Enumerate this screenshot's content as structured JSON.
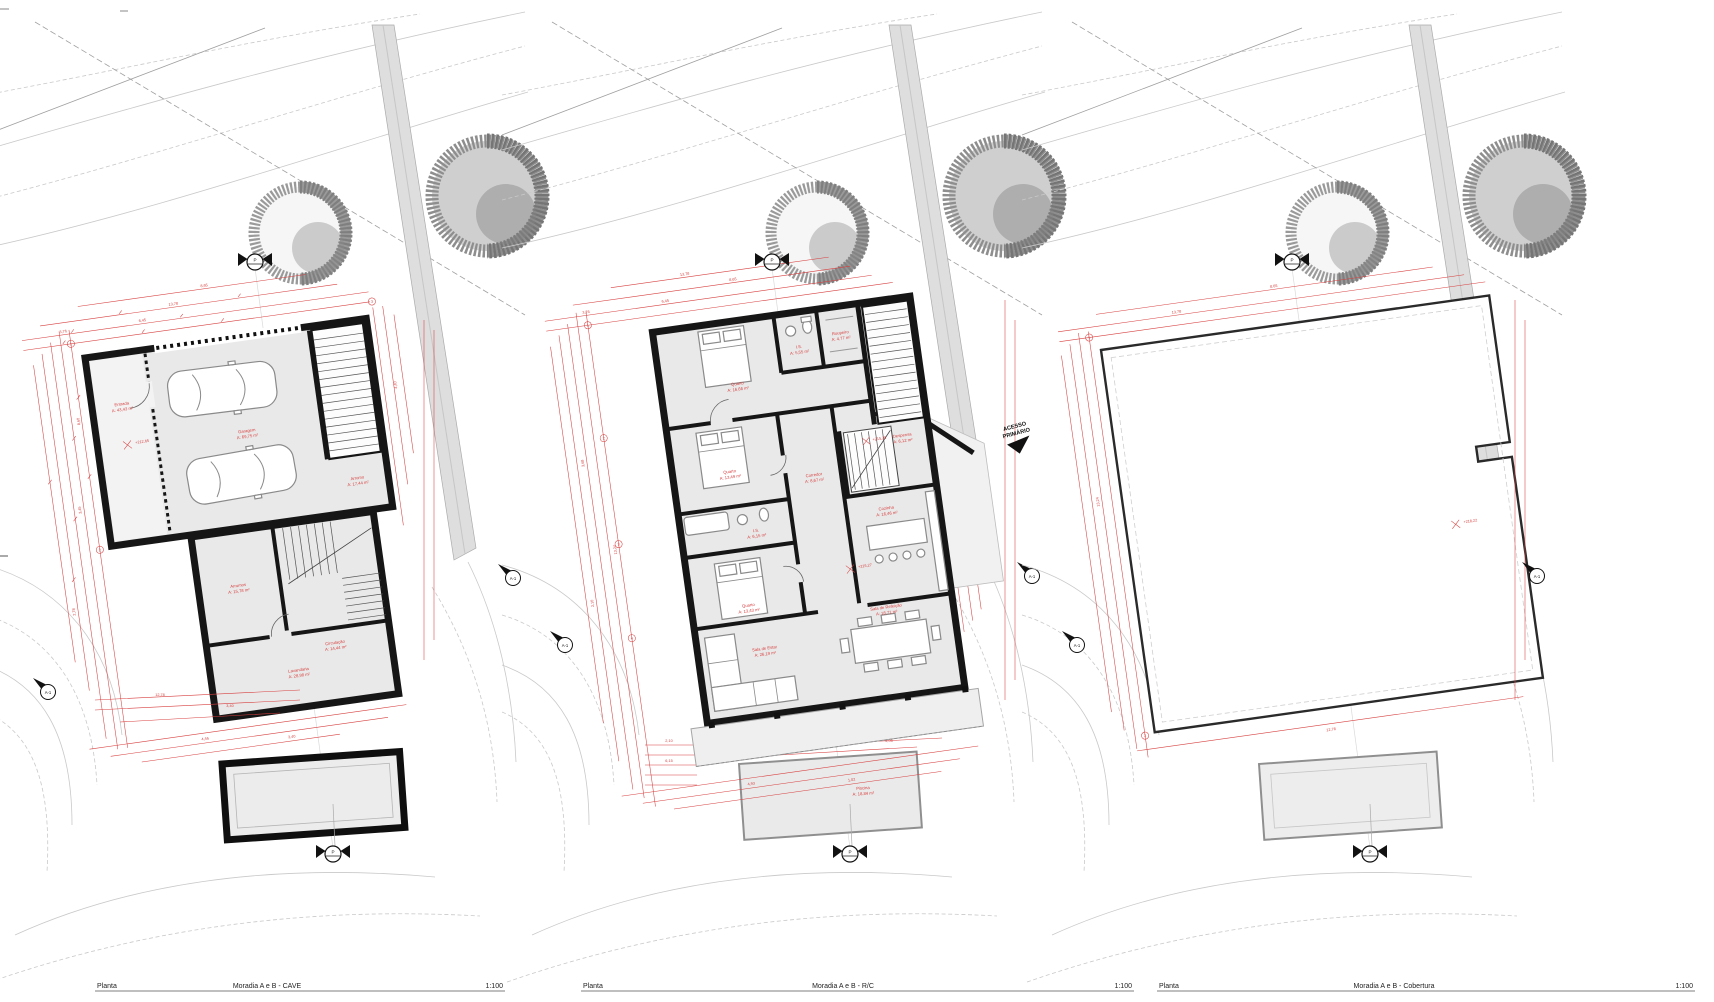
{
  "sheet": {
    "type": "Planta",
    "scale": "1:100"
  },
  "colors": {
    "dimension_red": "#d84040",
    "wall_black": "#161616",
    "floor_gray": "#e9e9e9"
  },
  "markers": {
    "section": "A-1",
    "cut": "P",
    "access_line1": "ACESSO",
    "access_line2": "PRIMÁRIO"
  },
  "dims": [
    "3,76",
    "6,45",
    "8,65",
    "13,78",
    "4,40",
    "3,45",
    "8,60",
    "2,78",
    "4,46",
    "3,40",
    "13,24",
    "12,78",
    "5,05",
    "1,02",
    "4,93",
    "3,68",
    "2,10",
    "6,15"
  ],
  "bubbles": [
    "1",
    "2",
    "3",
    "4"
  ],
  "panels": [
    {
      "footer": {
        "left": "Planta",
        "center": "Moradia A e B - CAVE",
        "scale": "1:100"
      },
      "elevation": "+212,65",
      "rooms": [
        {
          "name": "Garagem",
          "area": "A: 69,75 m²"
        },
        {
          "name": "Arrumo",
          "area": "A: 17,44 m²"
        },
        {
          "name": "Arrumos",
          "area": "A: 15,78 m²"
        },
        {
          "name": "Circulação",
          "area": "A: 14,44 m²"
        },
        {
          "name": "Lavandaria",
          "area": "A: 28,98 m²"
        },
        {
          "name": "Entrada",
          "area": "A: 43,43 m²"
        }
      ]
    },
    {
      "footer": {
        "left": "Planta",
        "center": "Moradia A e B - R/C",
        "scale": "1:100"
      },
      "elevation": "+215,27",
      "elevation2": "+215,25",
      "rooms": [
        {
          "name": "Quarto",
          "area": "A: 16,66 m²"
        },
        {
          "name": "I.S.",
          "area": "A: 5,55 m²"
        },
        {
          "name": "Roupeiro",
          "area": "A: 4,77 m²"
        },
        {
          "name": "Quarto",
          "area": "A: 13,49 m²"
        },
        {
          "name": "I.S.",
          "area": "A: 6,15 m²"
        },
        {
          "name": "Quarto",
          "area": "A: 13,43 m²"
        },
        {
          "name": "Corredor",
          "area": "A: 8,67 m²"
        },
        {
          "name": "Despensa",
          "area": "A: 6,12 m²"
        },
        {
          "name": "Cozinha",
          "area": "A: 16,46 m²"
        },
        {
          "name": "Sala de Estar",
          "area": "A: 26,19 m²"
        },
        {
          "name": "Sala de Refeição",
          "area": "A: 18,71 m²"
        },
        {
          "name": "Piscina",
          "area": "A: 18,84 m²"
        }
      ]
    },
    {
      "footer": {
        "left": "Planta",
        "center": "Moradia A e B - Cobertura",
        "scale": "1:100"
      },
      "elevation": "+218,22",
      "rooms": []
    }
  ]
}
